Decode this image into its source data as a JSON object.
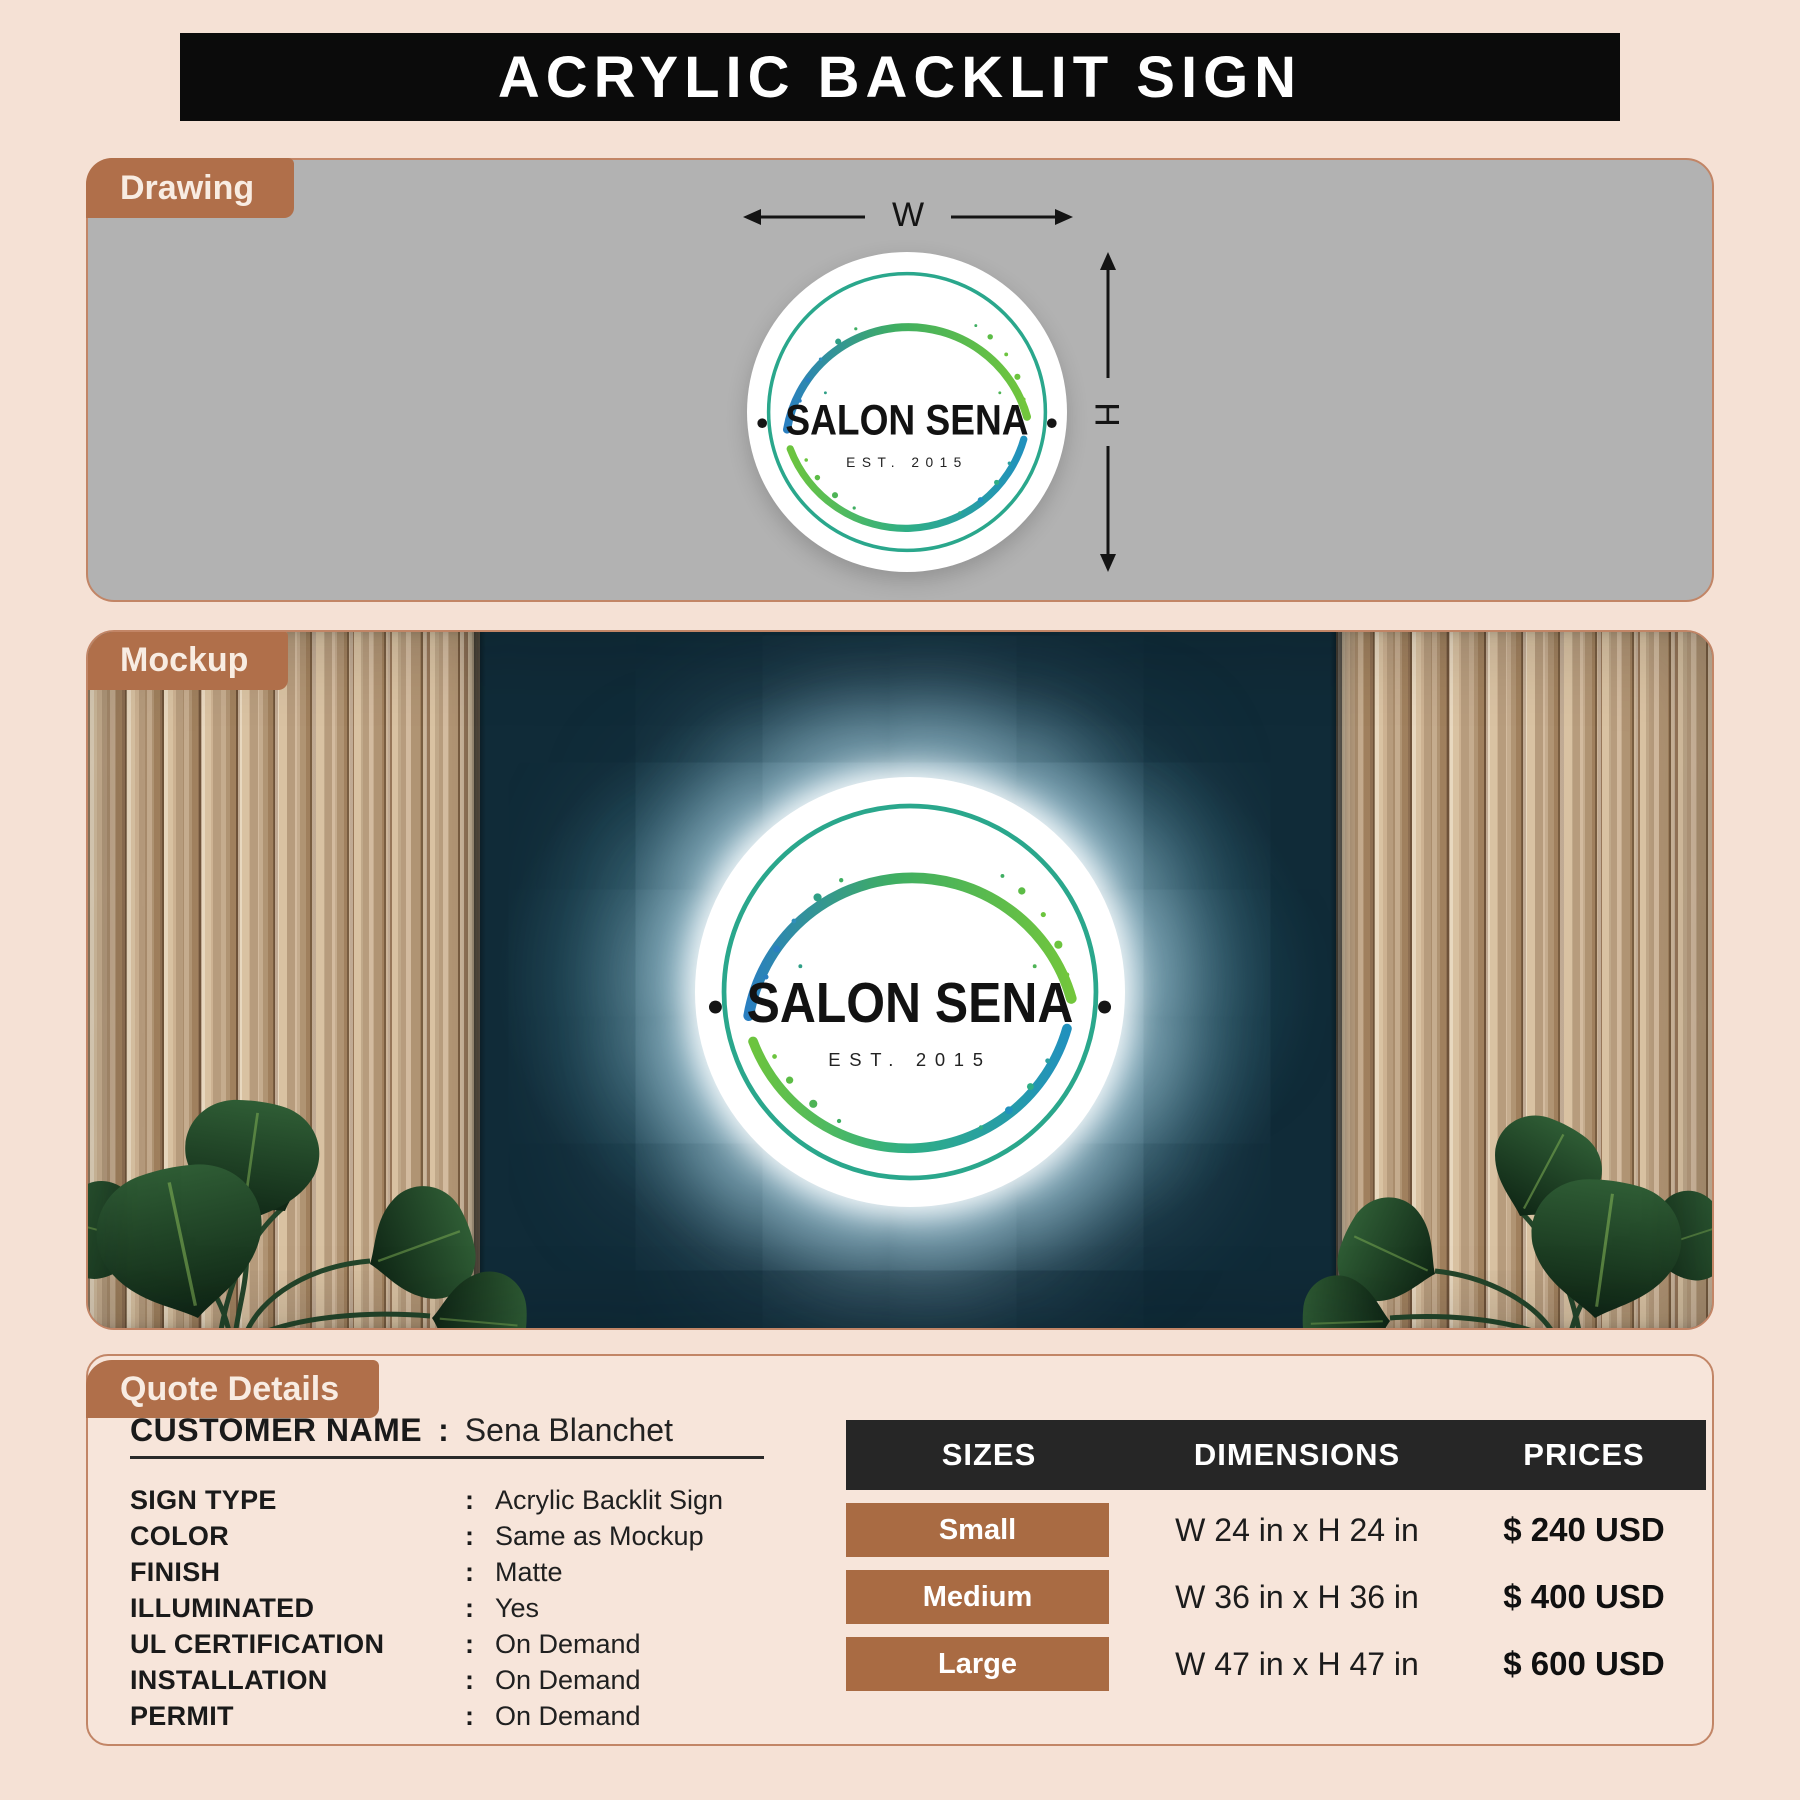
{
  "title": "ACRYLIC BACKLIT SIGN",
  "drawing": {
    "section_label": "Drawing",
    "width_label": "W",
    "height_label": "H",
    "sign": {
      "brand": "SALON SENA",
      "established": "EST. 2015"
    }
  },
  "mockup": {
    "section_label": "Mockup",
    "sign": {
      "brand": "SALON SENA",
      "established": "EST. 2015"
    }
  },
  "quote": {
    "section_label": "Quote Details",
    "separator": ":",
    "customer": {
      "label": "CUSTOMER NAME",
      "value": "Sena Blanchet"
    },
    "specs": [
      {
        "label": "SIGN TYPE",
        "value": "Acrylic Backlit Sign"
      },
      {
        "label": "COLOR",
        "value": "Same as Mockup"
      },
      {
        "label": "FINISH",
        "value": "Matte"
      },
      {
        "label": "ILLUMINATED",
        "value": "Yes"
      },
      {
        "label": "UL CERTIFICATION",
        "value": "On Demand"
      },
      {
        "label": "INSTALLATION",
        "value": "On Demand"
      },
      {
        "label": "PERMIT",
        "value": "On Demand"
      }
    ],
    "pricing_table": {
      "headers": [
        "SIZES",
        "DIMENSIONS",
        "PRICES"
      ],
      "rows": [
        {
          "size": "Small",
          "dimensions": "W 24 in x H 24 in",
          "price": "$ 240 USD"
        },
        {
          "size": "Medium",
          "dimensions": "W 36 in x H 36 in",
          "price": "$ 400 USD"
        },
        {
          "size": "Large",
          "dimensions": "W 47 in x H 47 in",
          "price": "$ 600 USD"
        }
      ]
    }
  },
  "colors": {
    "accent_brown": "#b06f4a",
    "size_chip_brown": "#a96b43",
    "panel_gray": "#b2b2b2",
    "wall_teal": "#1d4555",
    "banner_black": "#0b0b0b",
    "logo_ring_teal": "#2aa78c",
    "logo_green": "#6cc43e",
    "logo_blue": "#2a7fc0",
    "page_background": "#f5e1d5"
  }
}
